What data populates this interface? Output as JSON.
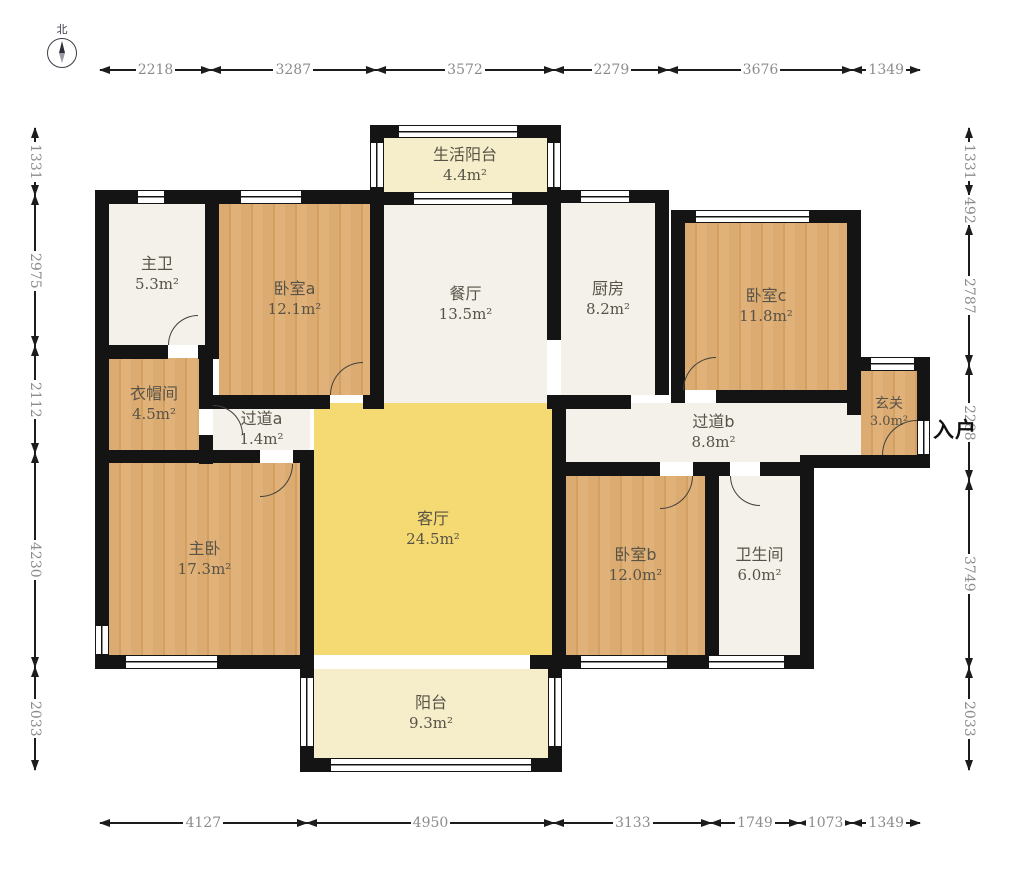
{
  "compass": {
    "north_label": "北"
  },
  "entry": {
    "label": "入户"
  },
  "rooms": [
    {
      "id": "life-balcony",
      "name": "生活阳台",
      "area": "4.4m²"
    },
    {
      "id": "master-bath",
      "name": "主卫",
      "area": "5.3m²"
    },
    {
      "id": "bedroom-a",
      "name": "卧室a",
      "area": "12.1m²"
    },
    {
      "id": "dining-room",
      "name": "餐厅",
      "area": "13.5m²"
    },
    {
      "id": "kitchen",
      "name": "厨房",
      "area": "8.2m²"
    },
    {
      "id": "bedroom-c",
      "name": "卧室c",
      "area": "11.8m²"
    },
    {
      "id": "closet",
      "name": "衣帽间",
      "area": "4.5m²"
    },
    {
      "id": "hallway-a",
      "name": "过道a",
      "area": "1.4m²"
    },
    {
      "id": "hallway-b",
      "name": "过道b",
      "area": "8.8m²"
    },
    {
      "id": "foyer",
      "name": "玄关",
      "area": "3.0m²"
    },
    {
      "id": "master-bedroom",
      "name": "主卧",
      "area": "17.3m²"
    },
    {
      "id": "living-room",
      "name": "客厅",
      "area": "24.5m²"
    },
    {
      "id": "bedroom-b",
      "name": "卧室b",
      "area": "12.0m²"
    },
    {
      "id": "bathroom",
      "name": "卫生间",
      "area": "6.0m²"
    },
    {
      "id": "balcony",
      "name": "阳台",
      "area": "9.3m²"
    }
  ],
  "dimensions": {
    "top": [
      "2218",
      "3287",
      "3572",
      "2279",
      "3676",
      "1349"
    ],
    "bottom": [
      "4127",
      "4950",
      "3133",
      "1749",
      "1073",
      "1349"
    ],
    "left": [
      "1331",
      "2975",
      "2112",
      "4230",
      "2033"
    ],
    "right": [
      "1331",
      "492",
      "2787",
      "2288",
      "3749",
      "2033"
    ]
  },
  "colors": {
    "wall": "#141414",
    "wood_floor": "#dcab72",
    "living_floor": "#f5d973",
    "balcony_floor": "#f6eecb",
    "tile_floor": "#f3f1ea",
    "dimension_text": "#8c8c8c"
  }
}
